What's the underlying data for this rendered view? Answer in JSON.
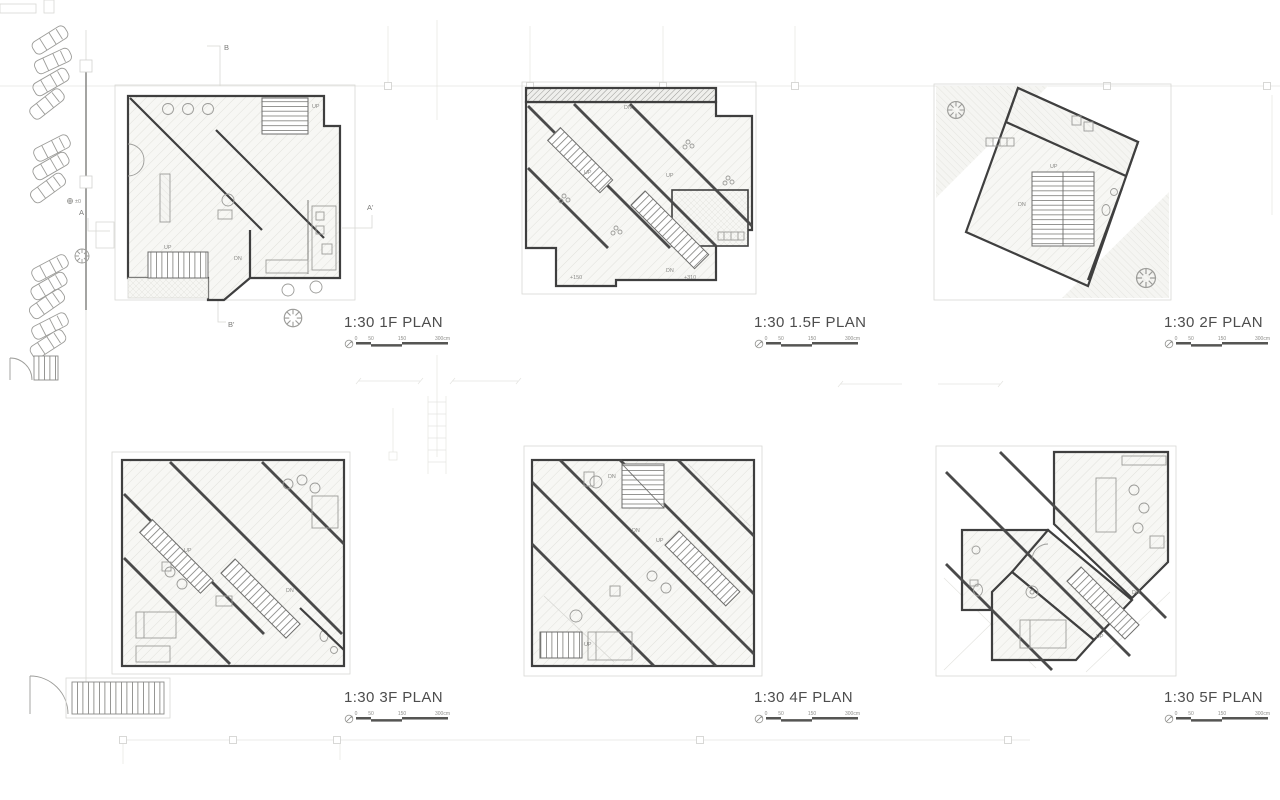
{
  "plans": [
    {
      "id": "1f",
      "label": "1:30 1F PLAN"
    },
    {
      "id": "1-5f",
      "label": "1:30 1.5F PLAN"
    },
    {
      "id": "2f",
      "label": "1:30 2F PLAN"
    },
    {
      "id": "3f",
      "label": "1:30 3F PLAN"
    },
    {
      "id": "4f",
      "label": "1:30 4F PLAN"
    },
    {
      "id": "5f",
      "label": "1:30 5F PLAN"
    }
  ],
  "scale_bar": {
    "ticks": [
      "0",
      "50",
      "150",
      "300cm"
    ]
  },
  "section_markers": {
    "a": "A",
    "a_prime": "A'",
    "b": "B",
    "b_prime": "B'"
  },
  "stair_labels": {
    "up": "UP",
    "dn": "DN"
  },
  "levels": {
    "zero": "±0",
    "plus150": "+150",
    "plus310": "+310"
  },
  "colors": {
    "wall": "#3f3f3f",
    "furniture": "#9c9c99",
    "faint": "#d8d8d4",
    "caption": "#4d4d4d"
  }
}
